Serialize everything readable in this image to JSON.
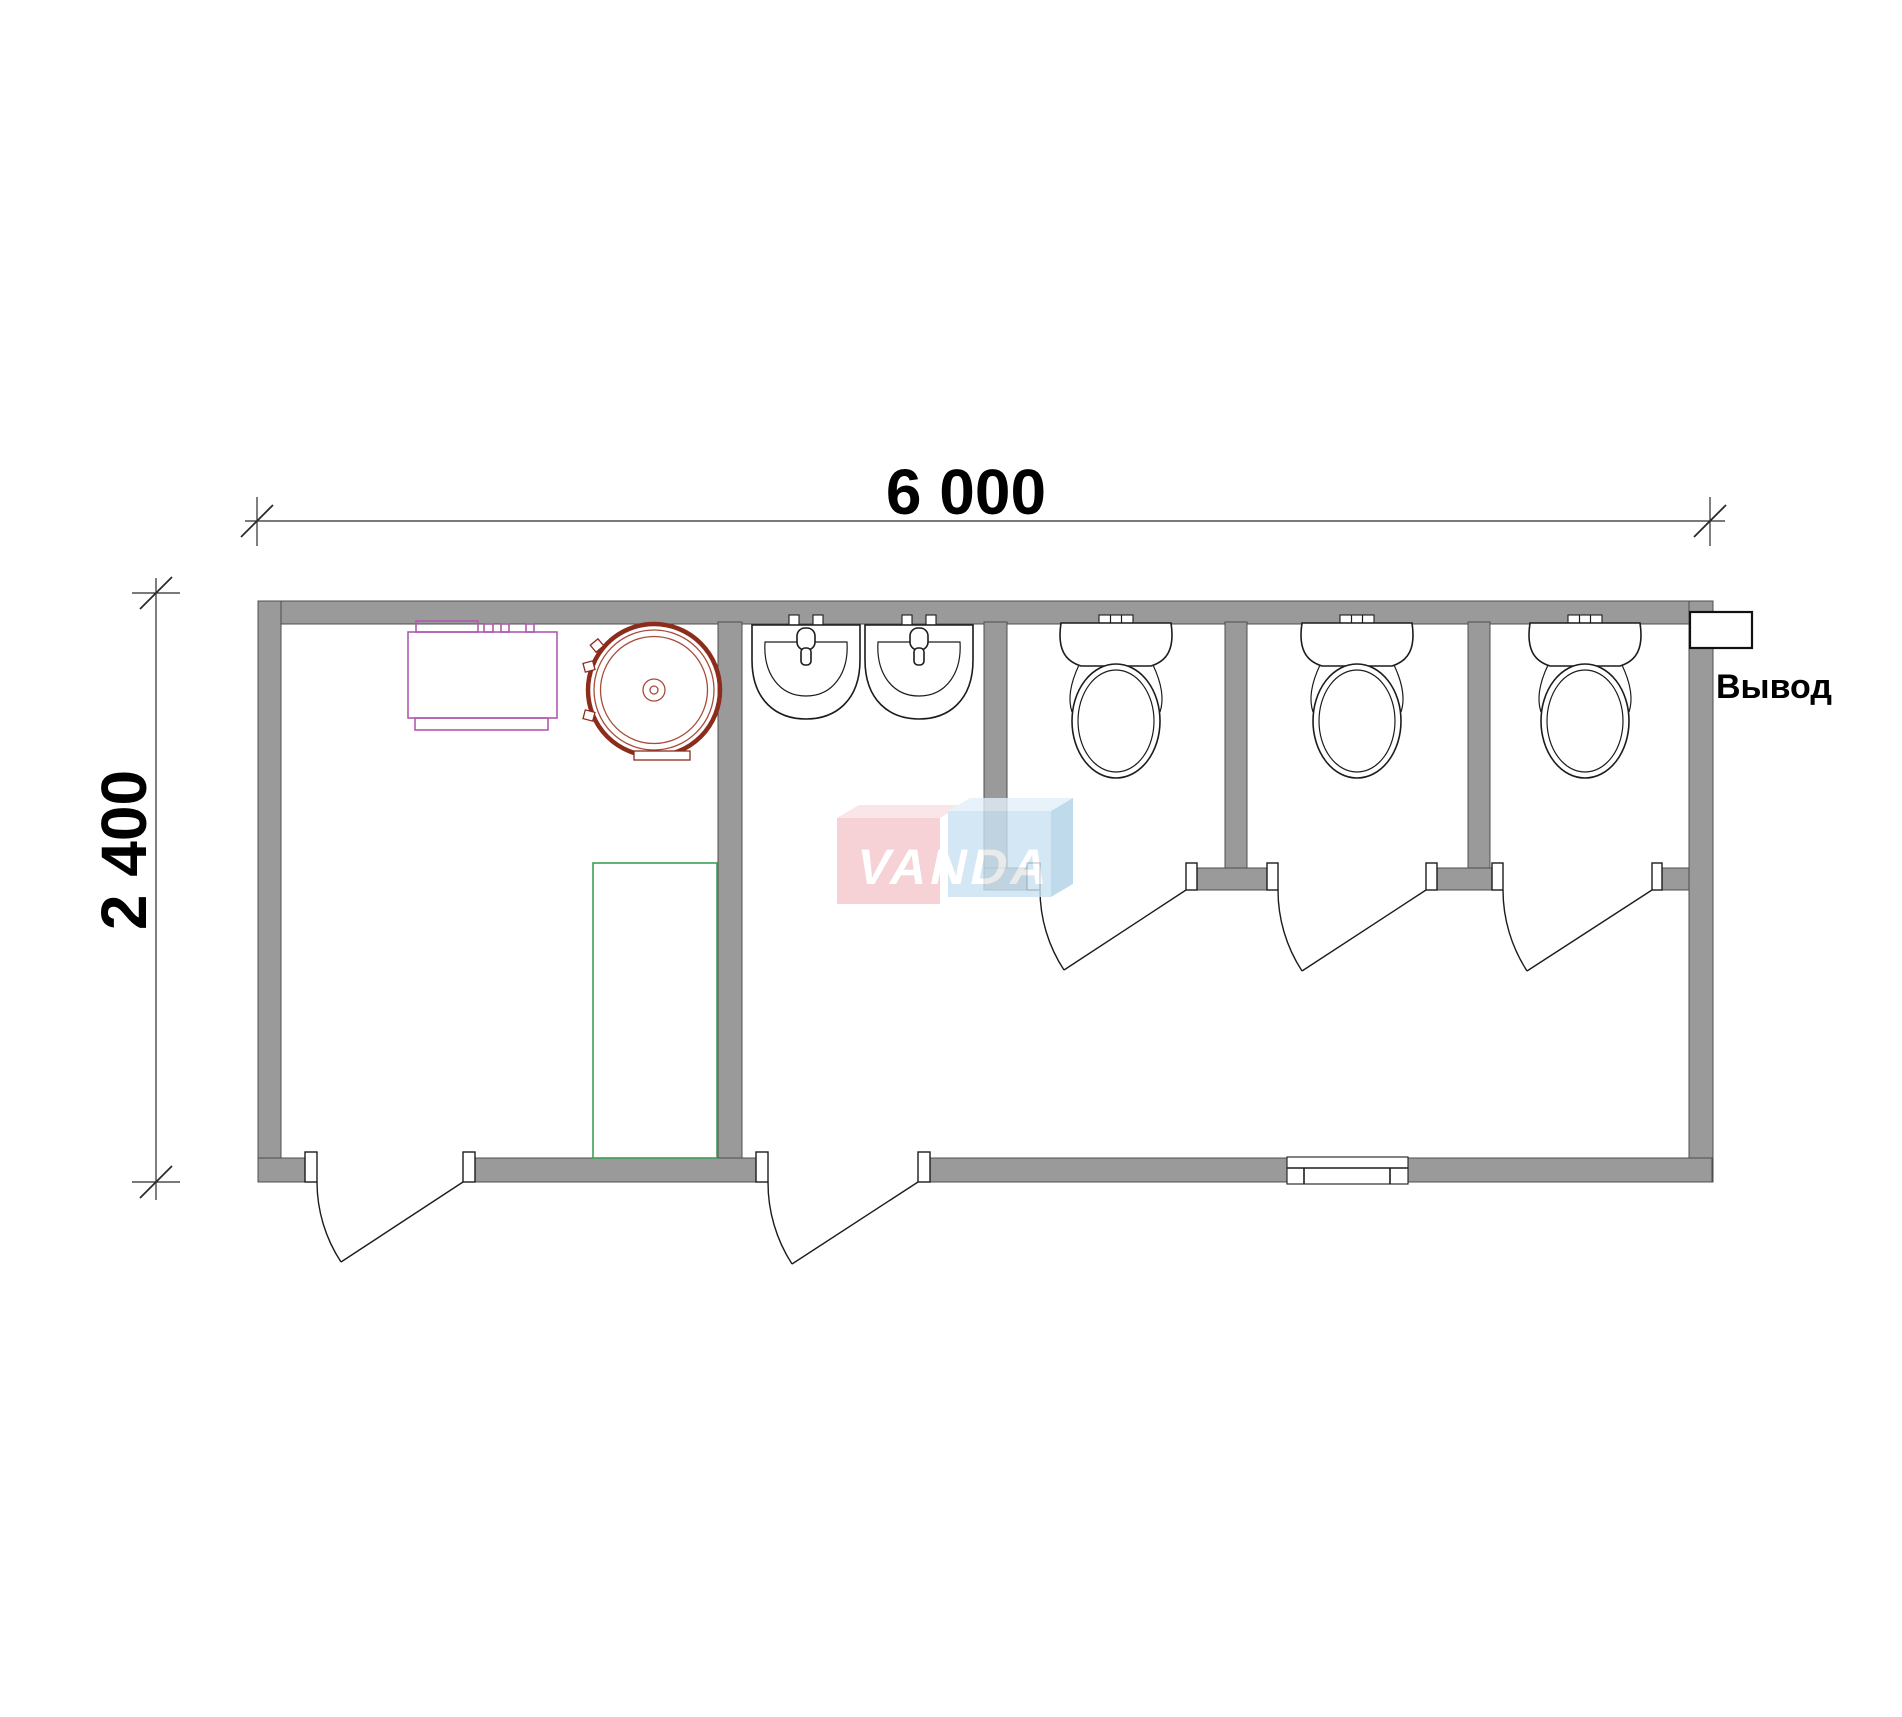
{
  "drawing": {
    "type": "architectural-floor-plan",
    "subject": "sanitary container 6000x2400 with utility room, washroom and 3 toilet stalls"
  },
  "dimensions": {
    "width_label": "6 000",
    "height_label": "2 400"
  },
  "annotations": {
    "outlet_label": "Вывод"
  },
  "watermark": {
    "text": "VANDA",
    "pink_block_color": "#f5c6cc",
    "blue_block_color": "#c9e2f2"
  },
  "colors": {
    "background": "#ffffff",
    "wall_fill": "#9a9a9a",
    "wall_edge": "#4f4f4f",
    "drawing_line": "#1c1c1c",
    "heater_outline": "#b05ab0",
    "tank_outline_dark": "#8c2c1c",
    "tank_outline_light": "#a84b3a",
    "shower_outline": "#3da05a"
  },
  "fixtures": {
    "left_room": [
      "water-heater",
      "round-water-tank",
      "shower-tray"
    ],
    "washroom": [
      "washbasin",
      "washbasin"
    ],
    "stalls": [
      "toilet",
      "toilet",
      "toilet"
    ],
    "openings": [
      "entry-door-left-room",
      "entry-door-washroom",
      "stall-door-1",
      "stall-door-2",
      "stall-door-3",
      "window"
    ]
  }
}
